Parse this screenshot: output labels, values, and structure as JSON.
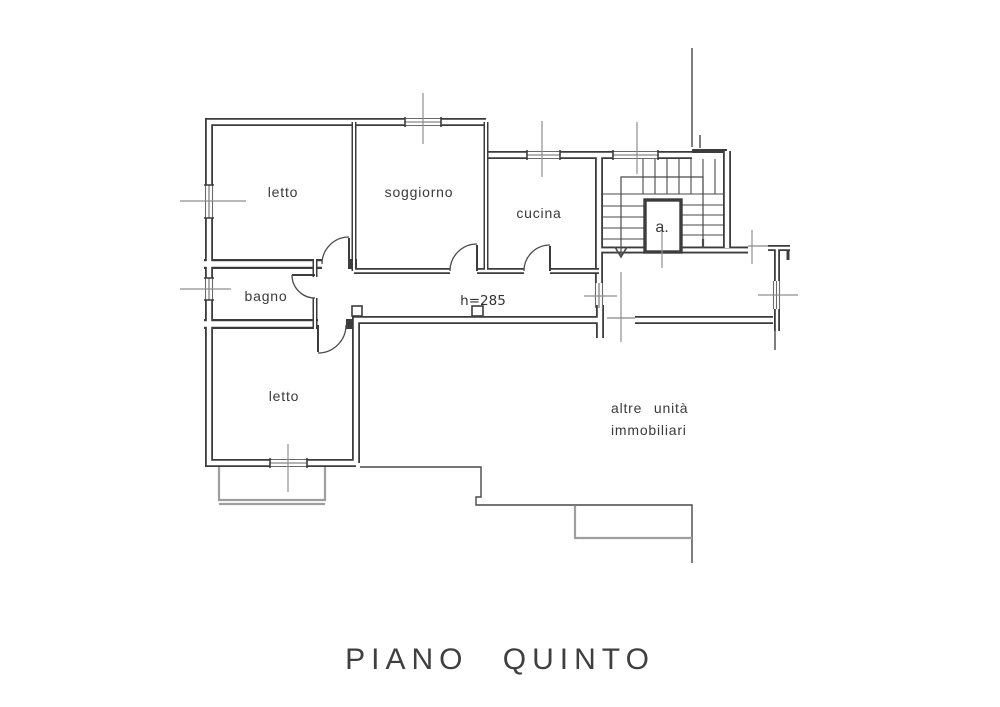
{
  "plan": {
    "title": "PIANO QUINTO",
    "rooms": {
      "letto1": "letto",
      "soggiorno": "soggiorno",
      "cucina": "cucina",
      "bagno": "bagno",
      "letto2": "letto"
    },
    "annotations": {
      "ceiling_height": "h=285",
      "elevator": "a.",
      "other_units_line1": "altre unità",
      "other_units_line2": "immobiliari"
    },
    "colors": {
      "wall": "#3c3c3c",
      "thin_line": "#4a4a4a",
      "tick": "#8f8f8f",
      "under_structure": "#9e9e9e",
      "background": "#ffffff"
    }
  }
}
